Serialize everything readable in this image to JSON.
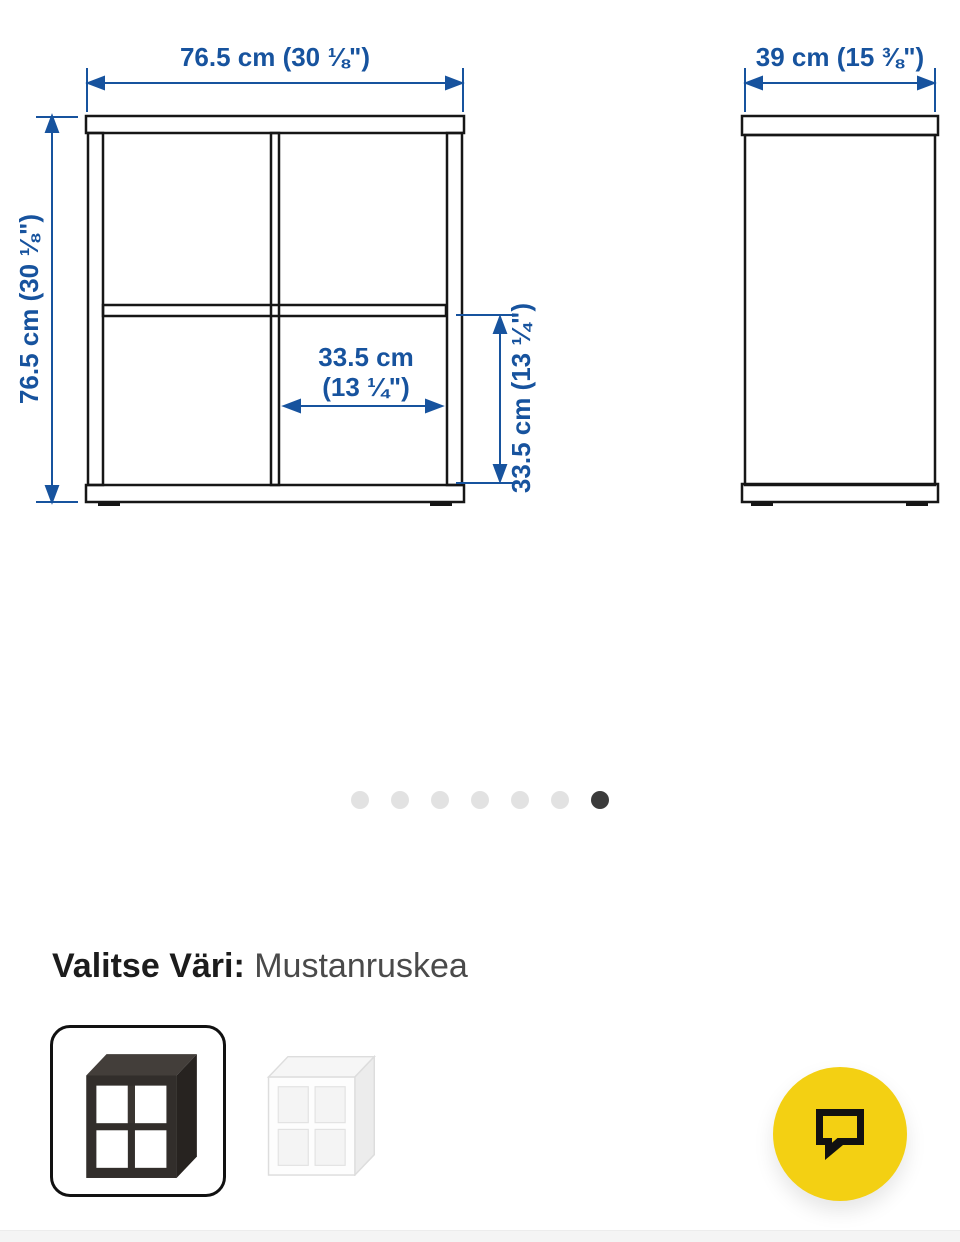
{
  "diagram": {
    "front": {
      "width_label": "76.5 cm (30 ⅛\")",
      "height_label": "76.5 cm (30 ⅛\")",
      "cell_width_line1": "33.5 cm",
      "cell_width_line2": "(13 ¼\")",
      "cell_height_label": "33.5 cm (13 ¼\")"
    },
    "side": {
      "depth_label": "39 cm (15 ⅜\")"
    },
    "dimension_color": "#17539E",
    "line_color": "#161616"
  },
  "carousel": {
    "dot_count": 7,
    "active_dot_index": 6
  },
  "variant_picker": {
    "label": "Valitse Väri:",
    "selected_value": "Mustanruskea",
    "options": [
      {
        "swatch": "black-brown-shelf-thumbnail",
        "selected": true
      },
      {
        "swatch": "white-shelf-thumbnail",
        "selected": false
      }
    ]
  },
  "chat": {
    "icon": "speech-bubble-icon",
    "background_color": "#F3D013"
  }
}
